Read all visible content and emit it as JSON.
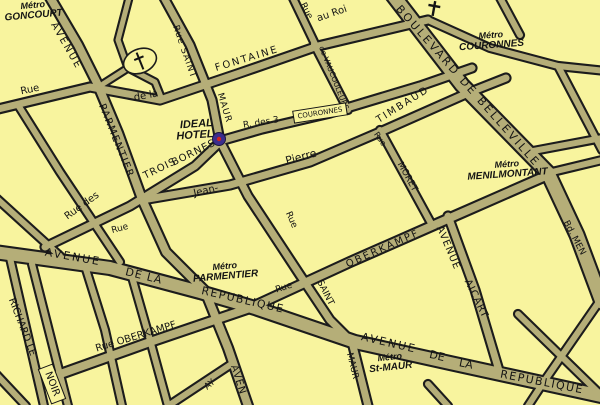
{
  "map": {
    "colors": {
      "background": "#f8f49e",
      "street_fill": "#b5ae78",
      "street_casing": "#1c1c1c",
      "label_black": "#141414",
      "metro_red": "#dd0000",
      "hotel_blue": "#1c18b0",
      "marker_outer": "#3b2d8d",
      "marker_inner": "#cc2222"
    },
    "streets": [
      {
        "id": "fontaine-au-roi",
        "w": 7,
        "pts": [
          [
            -6,
            110
          ],
          [
            90,
            87
          ],
          [
            160,
            100
          ],
          [
            240,
            73
          ],
          [
            318,
            46
          ],
          [
            428,
            20
          ]
        ]
      },
      {
        "id": "fontaine-au-roi-east",
        "w": 6,
        "pts": [
          [
            428,
            20
          ],
          [
            490,
            48
          ],
          [
            558,
            66
          ],
          [
            606,
            71
          ]
        ]
      },
      {
        "id": "top-branch",
        "w": 6,
        "pts": [
          [
            291,
            -6
          ],
          [
            316,
            46
          ]
        ]
      },
      {
        "id": "avenue-parmentier",
        "w": 8,
        "pts": [
          [
            48,
            -6
          ],
          [
            78,
            45
          ],
          [
            97,
            83
          ],
          [
            118,
            133
          ],
          [
            142,
            199
          ],
          [
            166,
            252
          ],
          [
            205,
            291
          ],
          [
            228,
            348
          ],
          [
            248,
            406
          ]
        ]
      },
      {
        "id": "rue-saint-maur",
        "w": 7,
        "pts": [
          [
            162,
            -6
          ],
          [
            190,
            45
          ],
          [
            212,
            100
          ],
          [
            220,
            141
          ],
          [
            248,
            196
          ],
          [
            300,
            275
          ],
          [
            330,
            320
          ],
          [
            352,
            342
          ],
          [
            368,
            406
          ]
        ]
      },
      {
        "id": "boulevard-de-belleville",
        "w": 13,
        "pts": [
          [
            392,
            -6
          ],
          [
            462,
            85
          ],
          [
            548,
            173
          ]
        ]
      },
      {
        "id": "boulevard-de-menilmontant",
        "w": 13,
        "pts": [
          [
            548,
            173
          ],
          [
            577,
            235
          ],
          [
            602,
            302
          ]
        ]
      },
      {
        "id": "avenue-de-la-republique",
        "w": 12,
        "pts": [
          [
            -6,
            252
          ],
          [
            110,
            268
          ],
          [
            200,
            292
          ],
          [
            255,
            308
          ],
          [
            355,
            342
          ],
          [
            450,
            363
          ],
          [
            606,
            397
          ]
        ]
      },
      {
        "id": "rue-oberkampf",
        "w": 8,
        "pts": [
          [
            52,
            377
          ],
          [
            150,
            342
          ],
          [
            250,
            308
          ],
          [
            350,
            262
          ],
          [
            450,
            218
          ],
          [
            548,
            175
          ]
        ]
      },
      {
        "id": "rue-jean-pierre-timbaud",
        "w": 7,
        "pts": [
          [
            142,
            200
          ],
          [
            230,
            185
          ],
          [
            310,
            162
          ],
          [
            380,
            132
          ],
          [
            468,
            93
          ],
          [
            506,
            78
          ]
        ]
      },
      {
        "id": "rue-des-trois-bornes",
        "w": 7,
        "pts": [
          [
            45,
            247
          ],
          [
            130,
            206
          ],
          [
            195,
            166
          ],
          [
            220,
            142
          ]
        ]
      },
      {
        "id": "rue-des-trois-couronnes",
        "w": 7,
        "pts": [
          [
            220,
            141
          ],
          [
            262,
            129
          ],
          [
            330,
            113
          ],
          [
            420,
            86
          ],
          [
            472,
            68
          ]
        ]
      },
      {
        "id": "rue-de-vaucouleurs",
        "w": 6,
        "pts": [
          [
            314,
            44
          ],
          [
            348,
            110
          ]
        ]
      },
      {
        "id": "rue-moret",
        "w": 6,
        "pts": [
          [
            380,
            130
          ],
          [
            432,
            225
          ]
        ]
      },
      {
        "id": "avenue-aicart",
        "w": 7,
        "pts": [
          [
            448,
            216
          ],
          [
            475,
            290
          ],
          [
            500,
            374
          ]
        ]
      },
      {
        "id": "richard-lenoir-west",
        "w": 6,
        "pts": [
          [
            10,
            258
          ],
          [
            44,
            406
          ]
        ]
      },
      {
        "id": "richard-lenoir-east",
        "w": 6,
        "pts": [
          [
            32,
            264
          ],
          [
            68,
            406
          ]
        ]
      },
      {
        "id": "left-diagonal",
        "w": 6,
        "pts": [
          [
            18,
            105
          ],
          [
            60,
            172
          ],
          [
            120,
            262
          ]
        ]
      },
      {
        "id": "left-low",
        "w": 6,
        "pts": [
          [
            -6,
            196
          ],
          [
            60,
            256
          ]
        ]
      },
      {
        "id": "church-loop",
        "w": 5,
        "pts": [
          [
            130,
            -6
          ],
          [
            118,
            40
          ],
          [
            128,
            68
          ],
          [
            155,
            82
          ],
          [
            161,
            97
          ]
        ]
      },
      {
        "id": "church-spur",
        "w": 5,
        "pts": [
          [
            128,
            68
          ],
          [
            103,
            84
          ]
        ]
      },
      {
        "id": "south-1",
        "w": 6,
        "pts": [
          [
            85,
            266
          ],
          [
            105,
            330
          ],
          [
            122,
            406
          ]
        ]
      },
      {
        "id": "south-2",
        "w": 6,
        "pts": [
          [
            132,
            277
          ],
          [
            150,
            340
          ],
          [
            168,
            406
          ]
        ]
      },
      {
        "id": "darboy",
        "w": 6,
        "pts": [
          [
            168,
            406
          ],
          [
            233,
            363
          ]
        ]
      },
      {
        "id": "sw-corner",
        "w": 6,
        "pts": [
          [
            -6,
            372
          ],
          [
            26,
            406
          ]
        ]
      },
      {
        "id": "east-top",
        "w": 6,
        "pts": [
          [
            498,
            -6
          ],
          [
            520,
            35
          ]
        ]
      },
      {
        "id": "east-1",
        "w": 6,
        "pts": [
          [
            558,
            66
          ],
          [
            602,
            150
          ]
        ]
      },
      {
        "id": "east-2",
        "w": 6,
        "pts": [
          [
            528,
            152
          ],
          [
            602,
            138
          ]
        ]
      },
      {
        "id": "menilmontant-east",
        "w": 6,
        "pts": [
          [
            548,
            173
          ],
          [
            602,
            160
          ]
        ]
      },
      {
        "id": "southeast-1",
        "w": 6,
        "pts": [
          [
            518,
            314
          ],
          [
            560,
            355
          ],
          [
            602,
            396
          ]
        ]
      },
      {
        "id": "southeast-2",
        "w": 6,
        "pts": [
          [
            599,
            302
          ],
          [
            545,
            380
          ],
          [
            528,
            406
          ]
        ]
      },
      {
        "id": "south-3",
        "w": 6,
        "pts": [
          [
            428,
            384
          ],
          [
            448,
            406
          ]
        ]
      }
    ],
    "street_labels": [
      {
        "id": "rue-nw",
        "t": "Rue",
        "x": 30,
        "y": 90,
        "r": -12,
        "s": 10
      },
      {
        "id": "avenue-parmentier-1",
        "t": "AVENUE",
        "x": 66,
        "y": 46,
        "r": 60,
        "s": 10,
        "sp": 2
      },
      {
        "id": "avenue-parmentier-2",
        "t": "PARMENTIER",
        "x": 116,
        "y": 141,
        "r": 68,
        "s": 10,
        "sp": 1.5
      },
      {
        "id": "de-la",
        "t": "de la",
        "x": 146,
        "y": 96,
        "r": -10,
        "s": 10
      },
      {
        "id": "rue-saint-top",
        "t": "Rue SAINT",
        "x": 184,
        "y": 52,
        "r": 71,
        "s": 9,
        "sp": 1
      },
      {
        "id": "maur-top",
        "t": "MAUR",
        "x": 224,
        "y": 108,
        "r": 73,
        "s": 9,
        "sp": 1
      },
      {
        "id": "fontaine",
        "t": "FONTAINE",
        "x": 247,
        "y": 59,
        "r": -17,
        "s": 10,
        "sp": 2
      },
      {
        "id": "rue-top",
        "t": "Rue",
        "x": 306,
        "y": 11,
        "r": 62,
        "s": 9
      },
      {
        "id": "au-roi",
        "t": "au Roi",
        "x": 332,
        "y": 14,
        "r": -19,
        "s": 10
      },
      {
        "id": "de-vaucouleurs",
        "t": "de VAUCOULEURS",
        "x": 334,
        "y": 78,
        "r": 68,
        "s": 7.5
      },
      {
        "id": "boulevard-de-belleville",
        "t": "BOULEVARD DE BELLEVILLE",
        "x": 468,
        "y": 86,
        "r": 48.5,
        "s": 11,
        "sp": 2.5
      },
      {
        "id": "timbaud",
        "t": "TIMBAUD",
        "x": 403,
        "y": 105,
        "r": -32,
        "s": 10,
        "sp": 2
      },
      {
        "id": "pierre",
        "t": "Pierre",
        "x": 301,
        "y": 157,
        "r": -15,
        "s": 11
      },
      {
        "id": "jean",
        "t": "Jean-",
        "x": 206,
        "y": 191,
        "r": -13,
        "s": 10
      },
      {
        "id": "rue-st-maur-mid",
        "t": "Rue",
        "x": 291,
        "y": 220,
        "r": 66,
        "s": 9
      },
      {
        "id": "saint-low",
        "t": "SAINT",
        "x": 325,
        "y": 293,
        "r": 63,
        "s": 9
      },
      {
        "id": "maur-bottom",
        "t": "MAUR",
        "x": 352,
        "y": 366,
        "r": 76,
        "s": 9
      },
      {
        "id": "rue-moret-1",
        "t": "Rue",
        "x": 380,
        "y": 139,
        "r": 55,
        "s": 8
      },
      {
        "id": "rue-moret-2",
        "t": "MORET",
        "x": 407,
        "y": 177,
        "r": 61,
        "s": 9
      },
      {
        "id": "rue-des",
        "t": "Rue des",
        "x": 82,
        "y": 206,
        "r": -36,
        "s": 10
      },
      {
        "id": "trois",
        "t": "TROIS",
        "x": 160,
        "y": 169,
        "r": -26,
        "s": 10,
        "sp": 1
      },
      {
        "id": "bornes",
        "t": "BORNES",
        "x": 194,
        "y": 153,
        "r": -26,
        "s": 10,
        "sp": 1
      },
      {
        "id": "r-des-3",
        "t": "R. des 3",
        "x": 261,
        "y": 123,
        "r": -9,
        "s": 9
      },
      {
        "id": "couronnes-box",
        "t": "COURONNES",
        "x": 320,
        "y": 113,
        "r": -9,
        "s": 7,
        "box": true
      },
      {
        "id": "oberkampf",
        "t": "OBERKAMPF",
        "x": 383,
        "y": 249,
        "r": -24,
        "s": 10,
        "sp": 2
      },
      {
        "id": "avenue-aicart-1",
        "t": "AVENUE",
        "x": 448,
        "y": 248,
        "r": 67,
        "s": 10,
        "sp": 1
      },
      {
        "id": "avenue-aicart-2",
        "t": "AICART",
        "x": 476,
        "y": 299,
        "r": 64,
        "s": 10,
        "sp": 1
      },
      {
        "id": "bd-men",
        "t": "Bd. MEN",
        "x": 574,
        "y": 238,
        "r": 62,
        "s": 9
      },
      {
        "id": "avenue-rep1-1",
        "t": "AVENUE",
        "x": 73,
        "y": 257,
        "r": 10,
        "s": 11,
        "sp": 2
      },
      {
        "id": "avenue-rep1-2",
        "t": "DE LA",
        "x": 144,
        "y": 276,
        "r": 14,
        "s": 11,
        "sp": 1
      },
      {
        "id": "avenue-rep1-3",
        "t": "REPUBLIQUE",
        "x": 243,
        "y": 300,
        "r": 13,
        "s": 11,
        "sp": 1.5
      },
      {
        "id": "avenue-rep2-1",
        "t": "AVENUE",
        "x": 389,
        "y": 343,
        "r": 13,
        "s": 11,
        "sp": 2
      },
      {
        "id": "avenue-rep2-2",
        "t": "DE",
        "x": 437,
        "y": 356,
        "r": 13,
        "s": 11
      },
      {
        "id": "avenue-rep2-3",
        "t": "LA",
        "x": 466,
        "y": 364,
        "r": 12,
        "s": 11
      },
      {
        "id": "avenue-rep2-4",
        "t": "REPUBLIQUE",
        "x": 542,
        "y": 382,
        "r": 11,
        "s": 11,
        "sp": 1.5
      },
      {
        "id": "rue-oberkampf-sw",
        "t": "Rue OBERKAMPF",
        "x": 136,
        "y": 337,
        "r": -17,
        "s": 10
      },
      {
        "id": "richard-le",
        "t": "RICHARD LE",
        "x": 22,
        "y": 327,
        "r": 69,
        "s": 10
      },
      {
        "id": "noir-box",
        "t": "NOIR",
        "x": 52,
        "y": 384,
        "r": 69,
        "s": 10,
        "box": true
      },
      {
        "id": "aven-south",
        "t": "AVEN",
        "x": 238,
        "y": 380,
        "r": 72,
        "s": 10,
        "sp": 1
      },
      {
        "id": "ay-partial",
        "t": "AY",
        "x": 210,
        "y": 385,
        "r": -40,
        "s": 9
      },
      {
        "id": "rue-mid-left",
        "t": "Rue",
        "x": 120,
        "y": 229,
        "r": -15,
        "s": 9
      },
      {
        "id": "rue-oberkampf-mid",
        "t": "Rue",
        "x": 284,
        "y": 288,
        "r": -18,
        "s": 9
      }
    ],
    "metro_stations": [
      {
        "id": "goncourt",
        "line1": "Métro",
        "line2": "GONCOURT",
        "x": 33,
        "y": 8,
        "r": -5
      },
      {
        "id": "couronnes",
        "line1": "Métro",
        "line2": "COURONNES",
        "x": 491,
        "y": 38,
        "r": -4
      },
      {
        "id": "menilmontant",
        "line1": "Métro",
        "line2": "MENILMONTANT",
        "x": 507,
        "y": 167,
        "r": -4
      },
      {
        "id": "parmentier",
        "line1": "Métro",
        "line2": "PARMENTIER",
        "x": 225,
        "y": 269,
        "r": -5
      },
      {
        "id": "st-maur",
        "line1": "Métro",
        "line2": "St-MAUR",
        "x": 390,
        "y": 360,
        "r": -6
      }
    ],
    "hotel": {
      "line1": "IDEAL",
      "line2": "HOTEL",
      "x": 213,
      "y": 126,
      "r": -4,
      "marker": {
        "x": 219,
        "y": 139,
        "radius": 6.5,
        "inner_radius": 2.2
      }
    },
    "landmarks": {
      "church_island": {
        "cx": 140,
        "cy": 61,
        "rx": 17,
        "ry": 12,
        "rot": -22
      },
      "cross": {
        "x": 434,
        "y": 8,
        "rot": 10
      }
    }
  }
}
